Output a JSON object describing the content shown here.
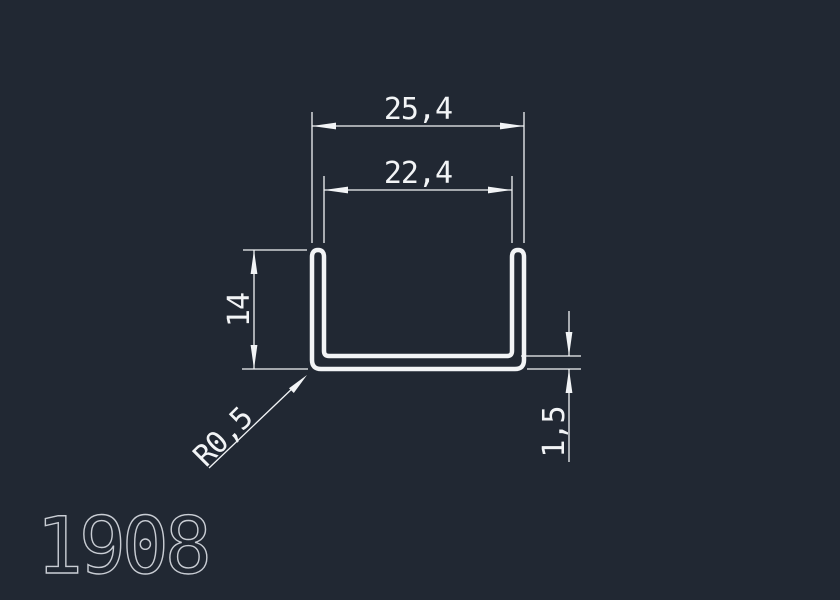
{
  "colors": {
    "background": "#212833",
    "line": "#f2f4f6",
    "part_number": "#c9cdd4"
  },
  "drawing": {
    "type": "u-channel-profile-cross-section",
    "part_number": "1908",
    "dimensions": {
      "outer_width": "25,4",
      "inner_width": "22,4",
      "height": "14",
      "thickness": "1,5",
      "corner_radius": "R0,5"
    }
  }
}
